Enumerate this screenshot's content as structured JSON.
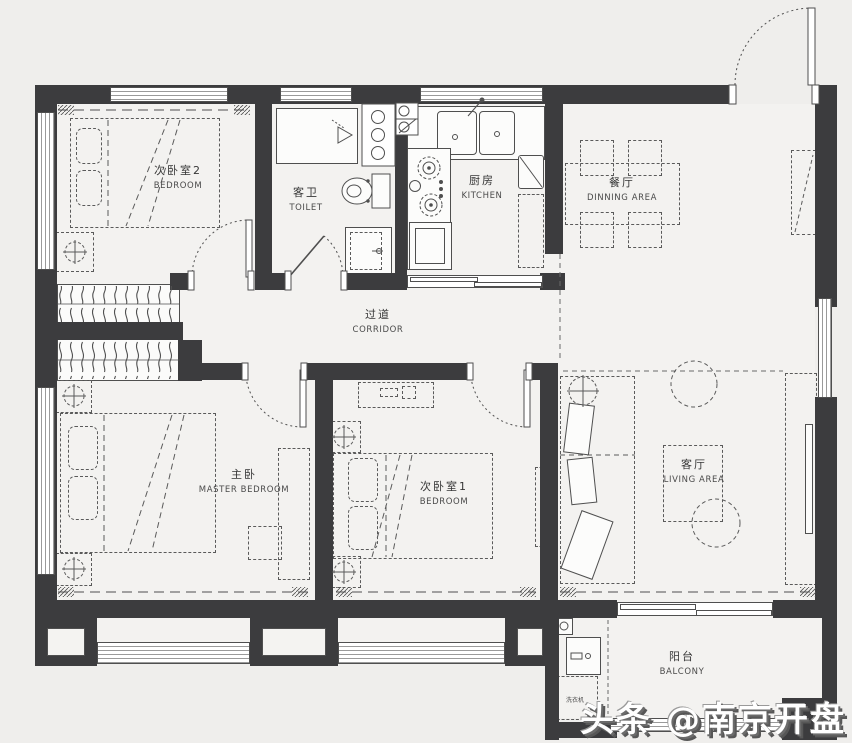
{
  "colors": {
    "background": "#efeeec",
    "wall": "#3c3c3e",
    "linework": "#4f4f4f",
    "fixture_fill": "#fcfcfb",
    "label_text": "#363636",
    "watermark_fill": "#ffffff",
    "watermark_shadow": "#575757"
  },
  "rooms": {
    "bedroom2": {
      "zh": "次卧室2",
      "en": "BEDROOM"
    },
    "toilet": {
      "zh": "客卫",
      "en": "TOILET"
    },
    "kitchen": {
      "zh": "厨房",
      "en": "KITCHEN"
    },
    "dining": {
      "zh": "餐厅",
      "en": "DINNING AREA"
    },
    "corridor": {
      "zh": "过道",
      "en": "CORRIDOR"
    },
    "master": {
      "zh": "主卧",
      "en": "MASTER BEDROOM"
    },
    "bedroom1": {
      "zh": "次卧室1",
      "en": "BEDROOM"
    },
    "living": {
      "zh": "客厅",
      "en": "LIVING AREA"
    },
    "balcony": {
      "zh": "阳台",
      "en": "BALCONY"
    }
  },
  "fixtures": {
    "washer": "洗衣机"
  },
  "watermark": {
    "text": "头条 @南京开盘"
  }
}
